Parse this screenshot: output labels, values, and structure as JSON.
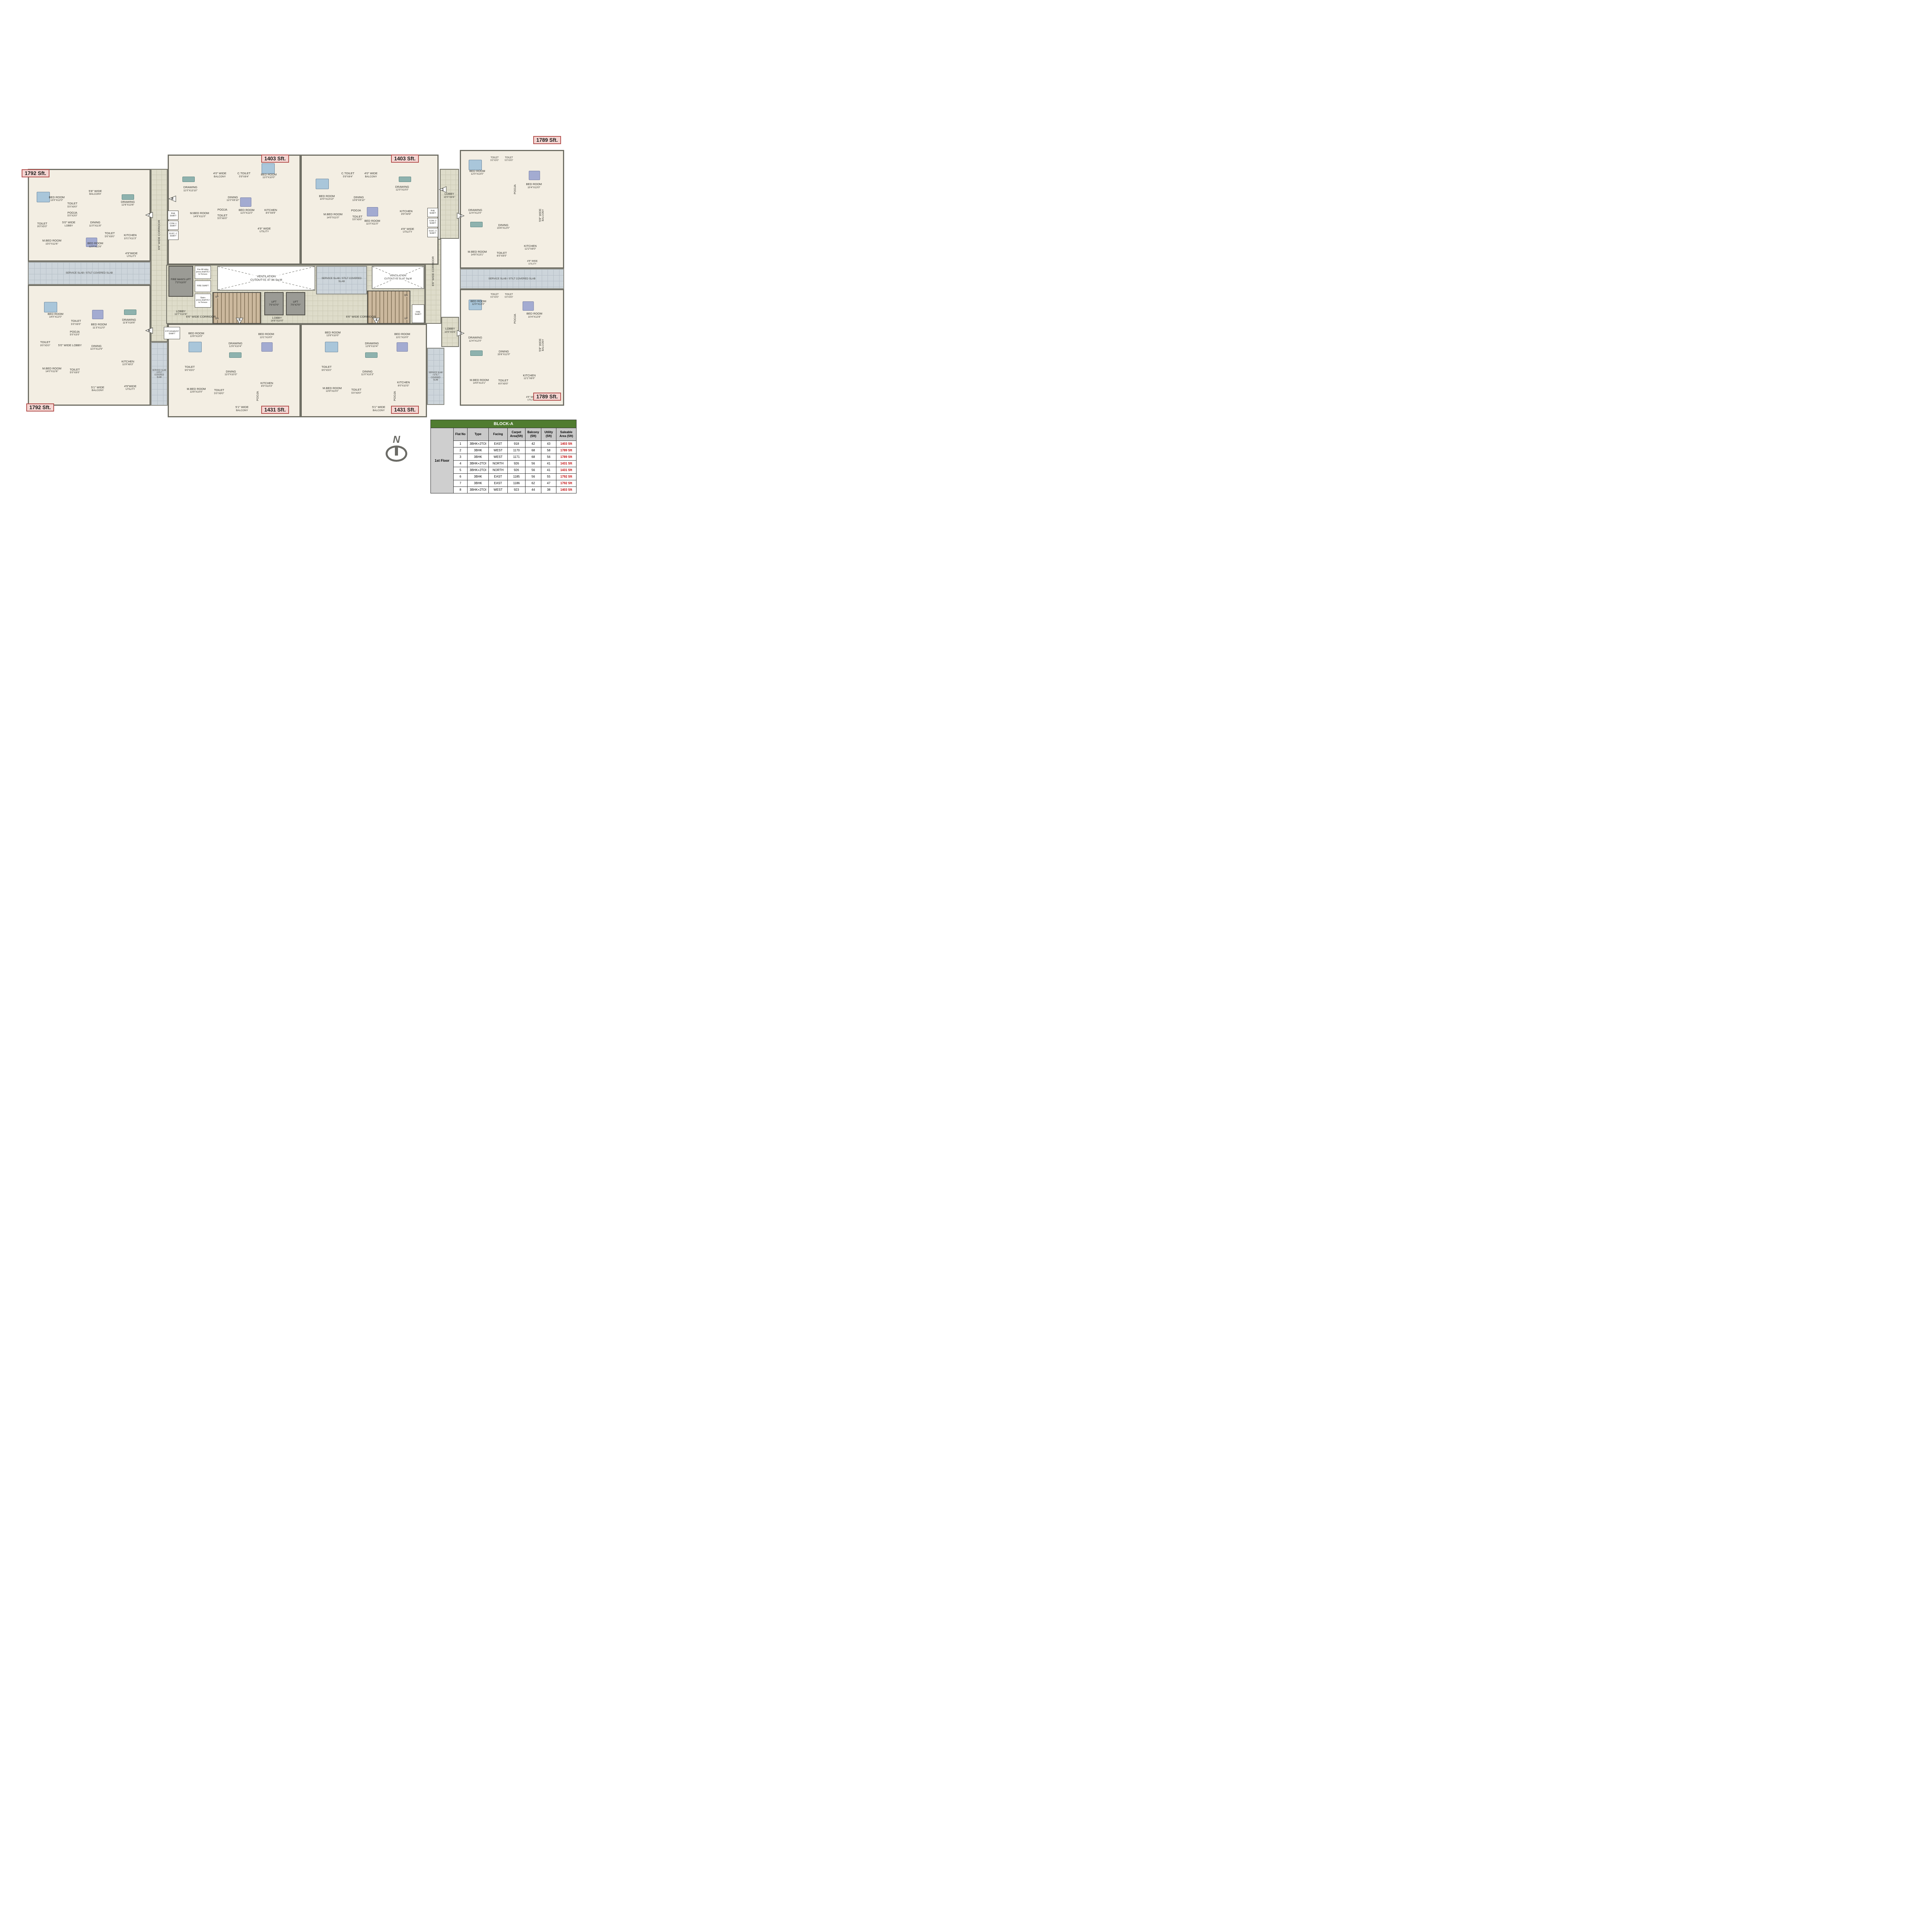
{
  "compass": {
    "letter": "N"
  },
  "areas": {
    "a7": "1792 Sft.",
    "a8": "1403 Sft.",
    "a1": "1403 Sft.",
    "a2": "1789 Sft.",
    "a6": "1792 Sft.",
    "a5": "1431 Sft.",
    "a4": "1431 Sft.",
    "a3": "1789 Sft."
  },
  "markers": {
    "m1": "1",
    "m2": "2",
    "m3": "3",
    "m4": "4",
    "m5": "5",
    "m6": "6",
    "m7": "7",
    "m8": "8"
  },
  "core": {
    "fireman": {
      "n": "FIRE MAN'S LIFT",
      "d": "7'3\"X10'0\""
    },
    "fire_lift_shaft": "Fire lift lobby press.shaft B-2 to Terrace",
    "lobby_left": {
      "n": "LOBBY",
      "d": "13'7\"X10'6\""
    },
    "fire_shaft": "FIRE SHAFT",
    "stairs_shaft": "Stairs press.shaft B-2 to Terrace",
    "up": "UP",
    "dn": "DN",
    "lift": {
      "n": "LIFT",
      "d": "7'0\"X7'0\""
    },
    "lobby_center": {
      "n": "LOBBY",
      "d": "14'8\"X10'0\""
    },
    "corridor": "6'6\" WIDE CORRIDOR",
    "cutout1": {
      "l1": "VENTILATION",
      "l2": "CUTOUT-01",
      "l3": "47.94 Sq.M"
    },
    "cutout2": {
      "l1": "VENTILATION",
      "l2": "CUTOUT-02",
      "l3": "31.67 Sq.M"
    },
    "service_slab": "SERVICE SLAB / STILT COVERED SLAB",
    "lobby_r_top": {
      "n": "LOBBY",
      "d": "10'0\"X8'6\""
    },
    "lobby_r_bot": {
      "n": "LOBBY",
      "d": "10'0\"X5'6\""
    },
    "stp": "STP EXHAUST SHAFT",
    "phe": "PHE SHAFT",
    "com1": "COM.-1 SHAFT",
    "elec1": "ELEC.-1 SHAFT",
    "com2": "COM.-2 SHAFT",
    "elec2": "ELEC.-2 SHAFT"
  },
  "flats": {
    "f7": {
      "rooms": {
        "bed1": {
          "n": "BED ROOM",
          "d": "13'0\"X12'0\""
        },
        "toilet1": {
          "n": "TOILET",
          "d": "5'0\"X9'0\""
        },
        "balcony": {
          "n": "5'8\" WIDE",
          "d": "BALCONY"
        },
        "drawing": {
          "n": "DRAWING",
          "d": "12'6\"X13'6\""
        },
        "pooja": {
          "n": "POOJA",
          "d": "5'0\"X3'0\""
        },
        "lobby": {
          "n": "5'0\" WIDE",
          "d": "LOBBY"
        },
        "dining": {
          "n": "DINING",
          "d": "11'0\"X11'8\""
        },
        "toilet2": {
          "n": "TOILET",
          "d": "9'0\"X5'0\""
        },
        "mbed": {
          "n": "M.BED ROOM",
          "d": "15'0\"X12'6\""
        },
        "bed2": {
          "n": "BED ROOM",
          "d": "12'0\"X12'6\""
        },
        "toilet3": {
          "n": "TOILET",
          "d": "5'0\"X9'0\""
        },
        "kitchen": {
          "n": "KITCHEN",
          "d": "10'1\"X11'3\""
        },
        "utility": {
          "n": "4'9\"WIDE",
          "d": "UTILITY"
        }
      }
    },
    "f8": {
      "rooms": {
        "drawing": {
          "n": "DRAWING",
          "d": "11'0\"X13'10\""
        },
        "balcony": {
          "n": "4'0\" WIDE",
          "d": "BALCONY"
        },
        "ctoilet": {
          "n": "C.TOILET",
          "d": "5'9\"X8'4\""
        },
        "bed1": {
          "n": "BED ROOM",
          "d": "11'0\"X10'0\""
        },
        "dining": {
          "n": "DINING",
          "d": "11'0\"X9'10\""
        },
        "mbed": {
          "n": "M.BED ROOM",
          "d": "14'9\"X11'0\""
        },
        "pooja": {
          "n": "POOJA"
        },
        "toilet": {
          "n": "TOILET",
          "d": "5'0\"X6'0\""
        },
        "bed2": {
          "n": "BED ROOM",
          "d": "11'0\"X11'0\""
        },
        "kitchen": {
          "n": "KITCHEN",
          "d": "8'0\"X9'9\""
        },
        "utility": {
          "n": "4'9\" WIDE",
          "d": "UTILITY"
        }
      }
    },
    "f1": {
      "rooms": {
        "bed1": {
          "n": "BED ROOM",
          "d": "10'0\"X13'10\""
        },
        "ctoilet": {
          "n": "C.TOILET",
          "d": "5'9\"X8'4\""
        },
        "balcony": {
          "n": "4'0\" WIDE",
          "d": "BALCONY"
        },
        "drawing": {
          "n": "DRAWING",
          "d": "12'0\"X10'0\""
        },
        "dining": {
          "n": "DINING",
          "d": "10'8\"X9'10\""
        },
        "mbed": {
          "n": "M.BED ROOM",
          "d": "14'0\"X11'0\""
        },
        "pooja": {
          "n": "POOJA"
        },
        "toilet": {
          "n": "TOILET",
          "d": "5'0\"X9'0\""
        },
        "bed2": {
          "n": "BED ROOM",
          "d": "11'0\"X11'0\""
        },
        "kitchen": {
          "n": "KITCHEN",
          "d": "8'9\"X9'9\""
        },
        "utility": {
          "n": "4'9\" WIDE",
          "d": "UTILITY"
        }
      }
    },
    "f2": {
      "rooms": {
        "bed1": {
          "n": "BED ROOM",
          "d": "12'0\"X13'0\""
        },
        "toilet1": {
          "n": "TOILET",
          "d": "5'0\"X9'0\""
        },
        "toilet2": {
          "n": "TOILET",
          "d": "5'0\"X9'0\""
        },
        "bed2": {
          "n": "BED ROOM",
          "d": "10'4\"X13'0\""
        },
        "pooja": {
          "n": "POOJA"
        },
        "drawing": {
          "n": "DRAWING",
          "d": "12'4\"X12'0\""
        },
        "dining": {
          "n": "DINING",
          "d": "15'6\"X12'0\""
        },
        "balcony": {
          "n": "5'8\" WIDE",
          "d": "BALCONY"
        },
        "mbed": {
          "n": "M.BED ROOM",
          "d": "14'8\"X13'1\""
        },
        "toilet3": {
          "n": "TOILET",
          "d": "6'0\"X9'0\""
        },
        "kitchen": {
          "n": "KITCHEN",
          "d": "12'2\"X8'0\""
        },
        "utility": {
          "n": "4'9\" WIDE",
          "d": "UTILITY"
        }
      }
    },
    "f3": {
      "rooms": {
        "bed1": {
          "n": "BED ROOM",
          "d": "12'0\"X13'0\""
        },
        "toilet1": {
          "n": "TOILET",
          "d": "5'0\"X9'0\""
        },
        "toilet2": {
          "n": "TOILET",
          "d": "5'0\"X9'0\""
        },
        "bed2": {
          "n": "BED ROOM",
          "d": "10'4\"X12'8\""
        },
        "pooja": {
          "n": "POOJA"
        },
        "drawing": {
          "n": "DRAWING",
          "d": "12'4\"X12'0\""
        },
        "dining": {
          "n": "DINING",
          "d": "15'6\"X12'0\""
        },
        "balcony": {
          "n": "5'8\" WIDE",
          "d": "BALCONY"
        },
        "mbed": {
          "n": "M.BED ROOM",
          "d": "14'9\"X13'1\""
        },
        "toilet3": {
          "n": "TOILET",
          "d": "6'0\"X9'0\""
        },
        "kitchen": {
          "n": "KITCHEN",
          "d": "12'1\"X8'0\""
        },
        "utility": {
          "n": "4'9\" WIDE",
          "d": "UTILITY"
        }
      }
    },
    "f5": {
      "rooms": {
        "bed1": {
          "n": "BED ROOM",
          "d": "13'9\"X10'0\""
        },
        "drawing": {
          "n": "DRAWING",
          "d": "12'6\"X10'4\""
        },
        "bed2": {
          "n": "BED ROOM",
          "d": "13'1\"X10'0\""
        },
        "toilet1": {
          "n": "TOILET",
          "d": "9'0\"X5'0\""
        },
        "dining": {
          "n": "DINING",
          "d": "11'0\"X10'3\""
        },
        "mbed": {
          "n": "M.BED ROOM",
          "d": "13'9\"X10'0\""
        },
        "toilet2": {
          "n": "TOILET",
          "d": "5'0\"X9'0\""
        },
        "kitchen": {
          "n": "KITCHEN",
          "d": "8'0\"X10'3\""
        },
        "pooja": {
          "n": "POOJA"
        },
        "balcony": {
          "n": "5'1\" WIDE",
          "d": "BALCONY"
        },
        "utility": {
          "n": "4'9\" WIDE",
          "d": "UTILITY"
        }
      }
    },
    "f4": {
      "rooms": {
        "bed1": {
          "n": "BED ROOM",
          "d": "13'9\"X10'0\""
        },
        "drawing": {
          "n": "DRAWING",
          "d": "12'6\"X10'4\""
        },
        "bed2": {
          "n": "BED ROOM",
          "d": "13'1\"X10'0\""
        },
        "toilet1": {
          "n": "TOILET",
          "d": "9'0\"X5'0\""
        },
        "dining": {
          "n": "DINING",
          "d": "11'0\"X10'3\""
        },
        "mbed": {
          "n": "M.BED ROOM",
          "d": "13'9\"X10'0\""
        },
        "toilet2": {
          "n": "TOILET",
          "d": "5'0\"X9'0\""
        },
        "kitchen": {
          "n": "KITCHEN",
          "d": "8'0\"X10'3\""
        },
        "pooja": {
          "n": "POOJA"
        },
        "balcony": {
          "n": "5'1\" WIDE",
          "d": "BALCONY"
        },
        "utility": {
          "n": "4'9\" WIDE",
          "d": "UTILITY"
        }
      }
    },
    "f6": {
      "rooms": {
        "bed1": {
          "n": "BED ROOM",
          "d": "14'0\"X12'0\""
        },
        "toilet1": {
          "n": "TOILET",
          "d": "5'0\"X9'0\""
        },
        "pooja": {
          "n": "POOJA",
          "d": "5'0\"X3'0\""
        },
        "bed2": {
          "n": "BED ROOM",
          "d": "11'3\"X12'0\""
        },
        "drawing": {
          "n": "DRAWING",
          "d": "11'6\"X16'6\""
        },
        "toilet2": {
          "n": "TOILET",
          "d": "9'0\"X5'0\""
        },
        "lobby": {
          "n": "5'0\" WIDE LOBBY"
        },
        "dining": {
          "n": "DINING",
          "d": "11'0\"X12'9\""
        },
        "mbed": {
          "n": "M.BED ROOM",
          "d": "14'0\"X12'6\""
        },
        "toilet3": {
          "n": "TOILET",
          "d": "5'0\"X9'0\""
        },
        "kitchen": {
          "n": "KITCHEN",
          "d": "11'9\"X8'3\""
        },
        "balcony": {
          "n": "5'1\" WIDE",
          "d": "BALCONY"
        },
        "utility": {
          "n": "4'9\"WIDE",
          "d": "UTILITY"
        }
      }
    }
  },
  "table": {
    "title": "BLOCK-A",
    "floor_label": "1st Floor",
    "columns": [
      {
        "l1": "Flat No",
        "l2": ""
      },
      {
        "l1": "Type",
        "l2": ""
      },
      {
        "l1": "Facing",
        "l2": ""
      },
      {
        "l1": "Carpet",
        "l2": "Area(Sft)"
      },
      {
        "l1": "Balcony",
        "l2": "(Sft)"
      },
      {
        "l1": "Utility",
        "l2": "(Sft)"
      },
      {
        "l1": "Saleable",
        "l2": "Area (Sft)"
      }
    ],
    "rows": [
      {
        "no": "1",
        "type": "3BHK+2TOI",
        "facing": "EAST",
        "carpet": "918",
        "balcony": "42",
        "utility": "43",
        "saleable": "1403 Sft"
      },
      {
        "no": "2",
        "type": "3BHK",
        "facing": "WEST",
        "carpet": "1170",
        "balcony": "68",
        "utility": "58",
        "saleable": "1789 Sft"
      },
      {
        "no": "3",
        "type": "3BHK",
        "facing": "WEST",
        "carpet": "1171",
        "balcony": "68",
        "utility": "56",
        "saleable": "1789 Sft"
      },
      {
        "no": "4",
        "type": "3BHK+2TOI",
        "facing": "NORTH",
        "carpet": "926",
        "balcony": "56",
        "utility": "41",
        "saleable": "1431 Sft"
      },
      {
        "no": "5",
        "type": "3BHK+2TOI",
        "facing": "NORTH",
        "carpet": "926",
        "balcony": "56",
        "utility": "41",
        "saleable": "1431 Sft"
      },
      {
        "no": "6",
        "type": "3BHK",
        "facing": "EAST",
        "carpet": "1185",
        "balcony": "56",
        "utility": "55",
        "saleable": "1792 Sft"
      },
      {
        "no": "7",
        "type": "3BHK",
        "facing": "EAST",
        "carpet": "1186",
        "balcony": "62",
        "utility": "47",
        "saleable": "1792 Sft"
      },
      {
        "no": "8",
        "type": "3BHK+2TOI",
        "facing": "WEST",
        "carpet": "923",
        "balcony": "44",
        "utility": "38",
        "saleable": "1403 Sft"
      }
    ]
  }
}
